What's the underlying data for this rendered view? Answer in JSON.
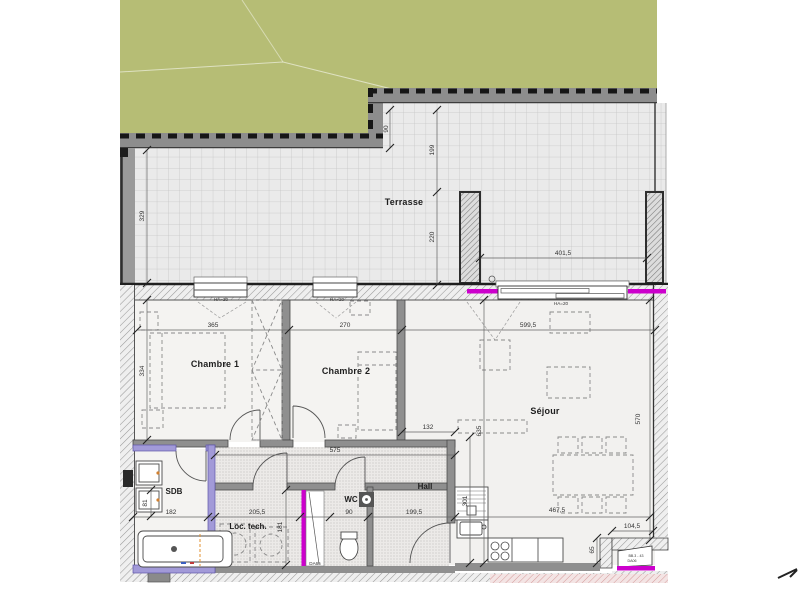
{
  "plan": {
    "rooms": {
      "terrace": "Terrasse",
      "bedroom1": "Chambre 1",
      "bedroom2": "Chambre 2",
      "living": "Séjour",
      "bathroom": "SDB",
      "technical": "Loc. tech.",
      "wc": "WC",
      "hall": "Hall"
    },
    "dimensions": {
      "terrace_side": "329",
      "terrace_step": "90",
      "terrace_depth_1": "199",
      "terrace_depth_2": "220",
      "terrace_bay": "401,5",
      "bedroom1_width": "365",
      "bedroom2_width": "270",
      "living_width": "599,5",
      "bedroom1_depth": "334",
      "living_depth": "570",
      "living_length": "635",
      "kitchen_column": "301",
      "living_gap": "132",
      "corridor_length": "575",
      "bathroom_width": "182",
      "technical_width": "205,5",
      "wc_width": "90",
      "hall_width": "199,5",
      "kitchen_run": "467,5",
      "entry_width": "104,5",
      "entry_depth": "65",
      "technical_depth": "181",
      "basin_offset": "81"
    },
    "labels": {
      "window_sill": "HA=20",
      "interior_door": "DA65",
      "entrance_door_line1": "BB.3 - 43",
      "entrance_door_line2": "DA06"
    },
    "colors": {
      "grass": "#b6bd75",
      "magenta": "#cc00cc",
      "purple_wall": "#a29ad8",
      "wall_gray": "#8d8d8d",
      "tile_floor": "#eaeaea"
    }
  }
}
